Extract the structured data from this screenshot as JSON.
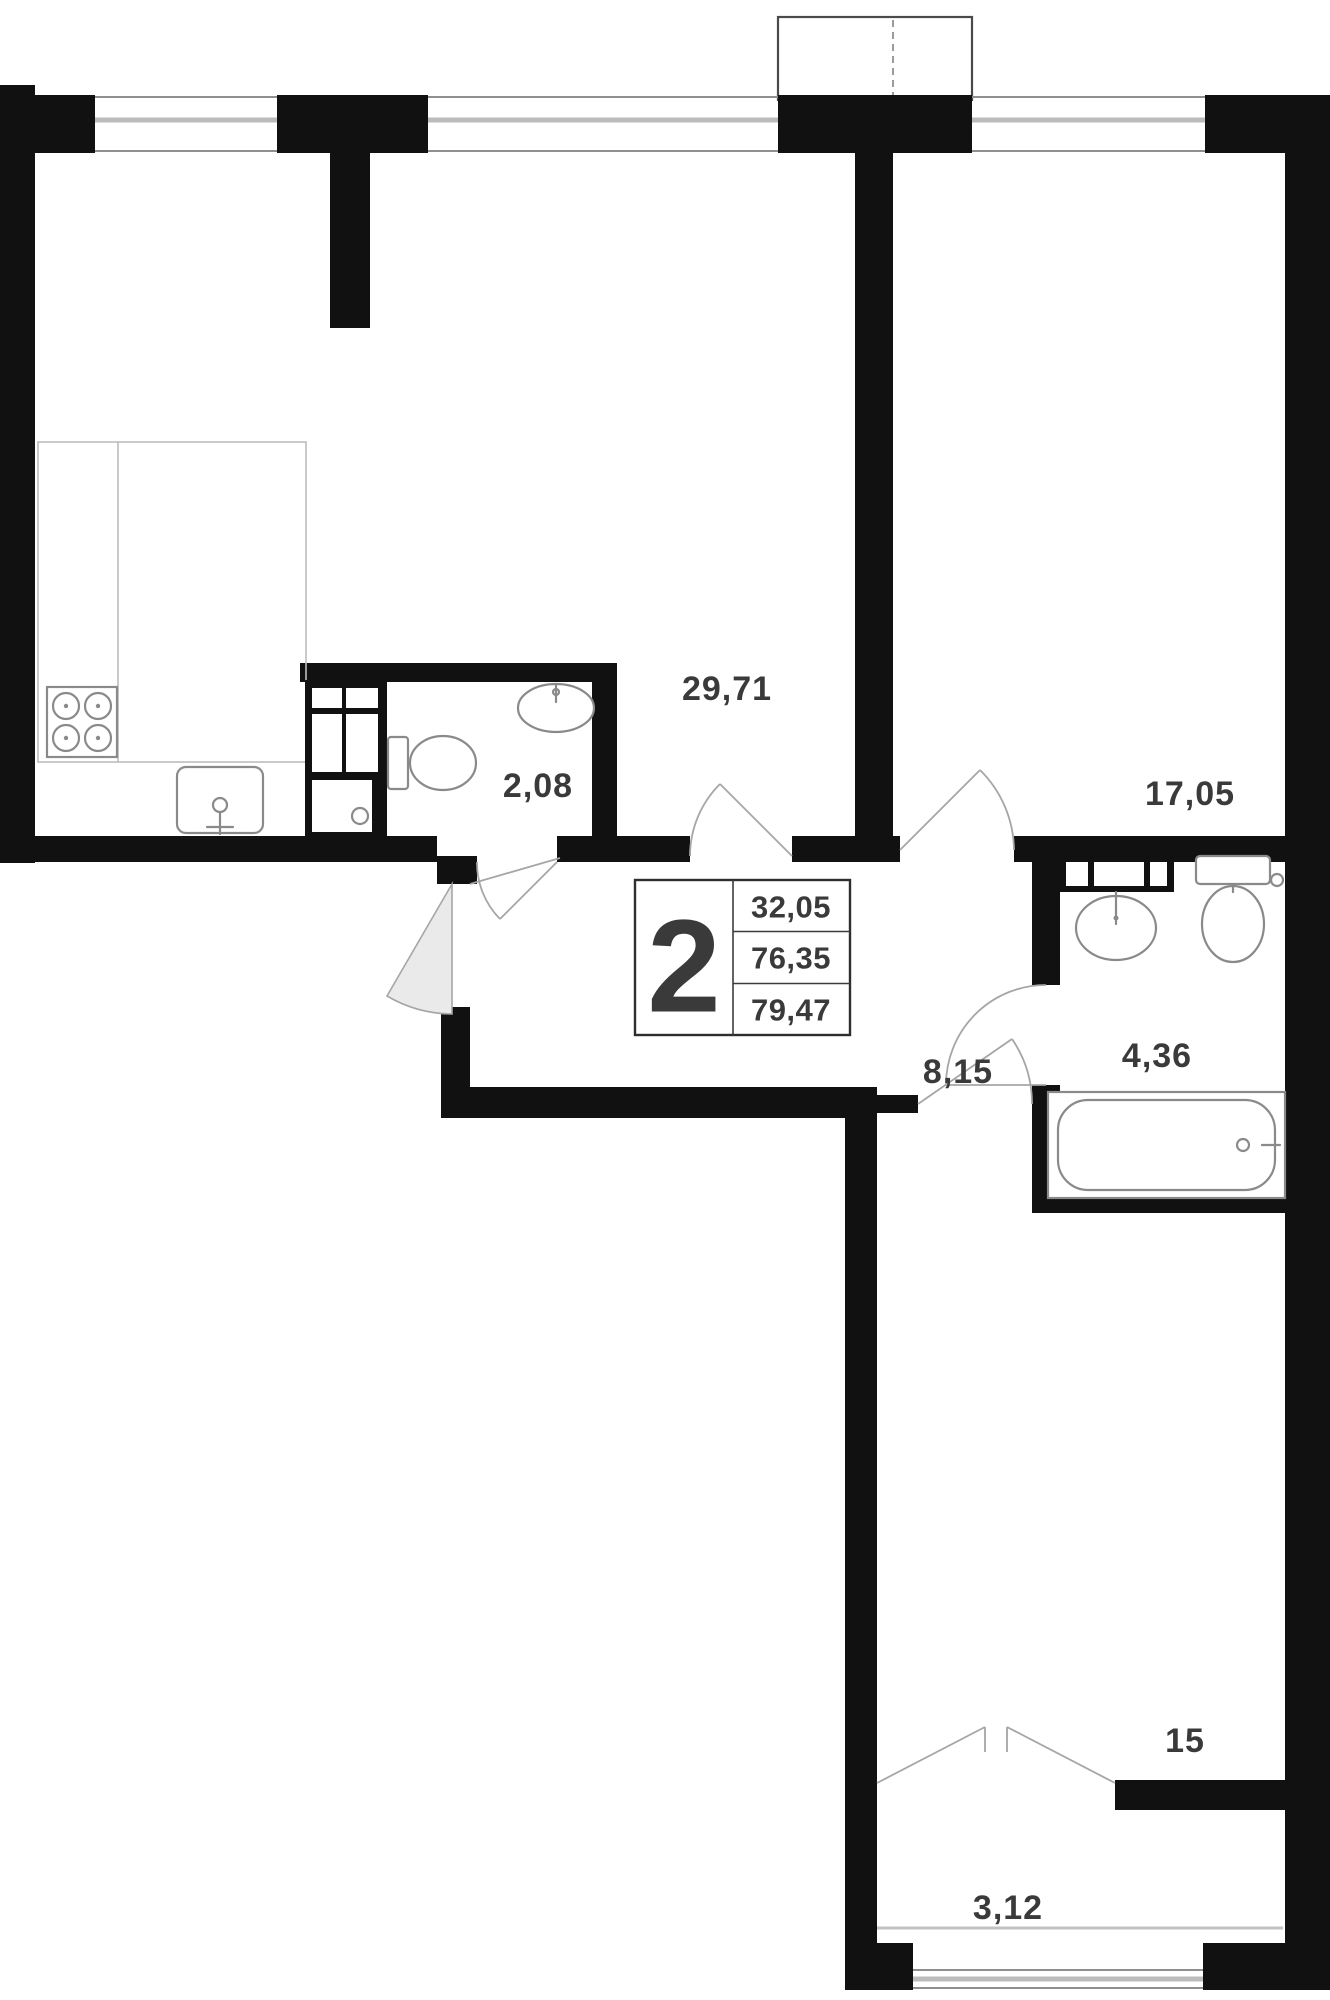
{
  "rooms": {
    "living": "29,71",
    "wc": "2,08",
    "bedroom": "17,05",
    "hall": "8,15",
    "bath": "4,36",
    "bedroom2": "15",
    "balcony": "3,12"
  },
  "info_box": {
    "room_count": "2",
    "line1": "32,05",
    "line2": "76,35",
    "line3": "79,47"
  },
  "colors": {
    "wall": "#111111",
    "fixture": "#8a8a8a",
    "door_fill": "#eaeaea",
    "text": "#3a3a3a"
  }
}
